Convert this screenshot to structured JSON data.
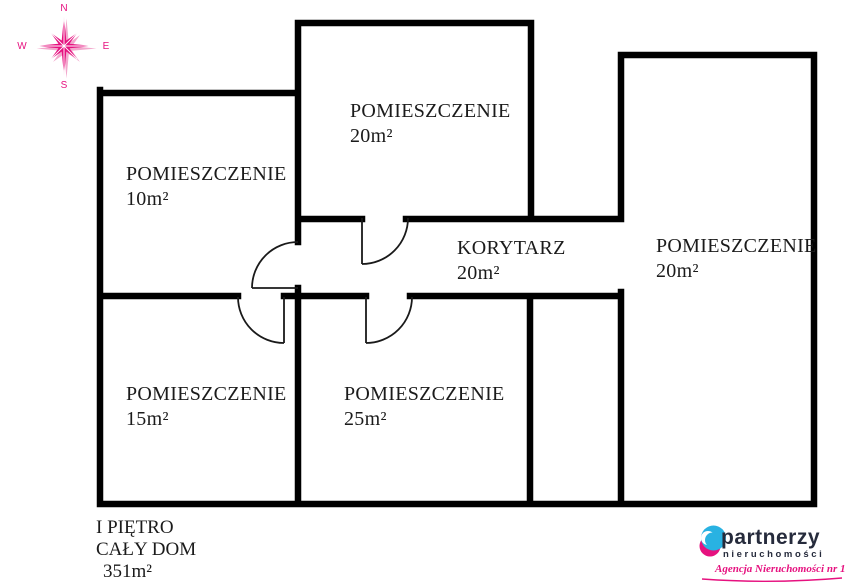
{
  "compass": {
    "n": "N",
    "e": "E",
    "s": "S",
    "w": "W"
  },
  "rooms": {
    "top": {
      "label": "POMIESZCZENIE",
      "area": "20m²"
    },
    "left": {
      "label": "POMIESZCZENIE",
      "area": "10m²"
    },
    "right": {
      "label": "POMIESZCZENIE",
      "area": "20m²"
    },
    "corridor": {
      "label": "KORYTARZ",
      "area": "20m²"
    },
    "bottom_left": {
      "label": "POMIESZCZENIE",
      "area": "15m²"
    },
    "bottom_middle": {
      "label": "POMIESZCZENIE",
      "area": "25m²"
    }
  },
  "footer": {
    "floor": "I PIĘTRO",
    "scope": "CAŁY DOM",
    "total_area": "351m²"
  },
  "logo": {
    "brand": "partnerzy",
    "brand_sub": "nieruchomości",
    "tagline": "Agencja Nieruchomości nr 1"
  },
  "colors": {
    "wall": "#000000",
    "accent_pink": "#e6117f",
    "logo_navy": "#262b3c",
    "logo_blue": "#29b2e2"
  }
}
